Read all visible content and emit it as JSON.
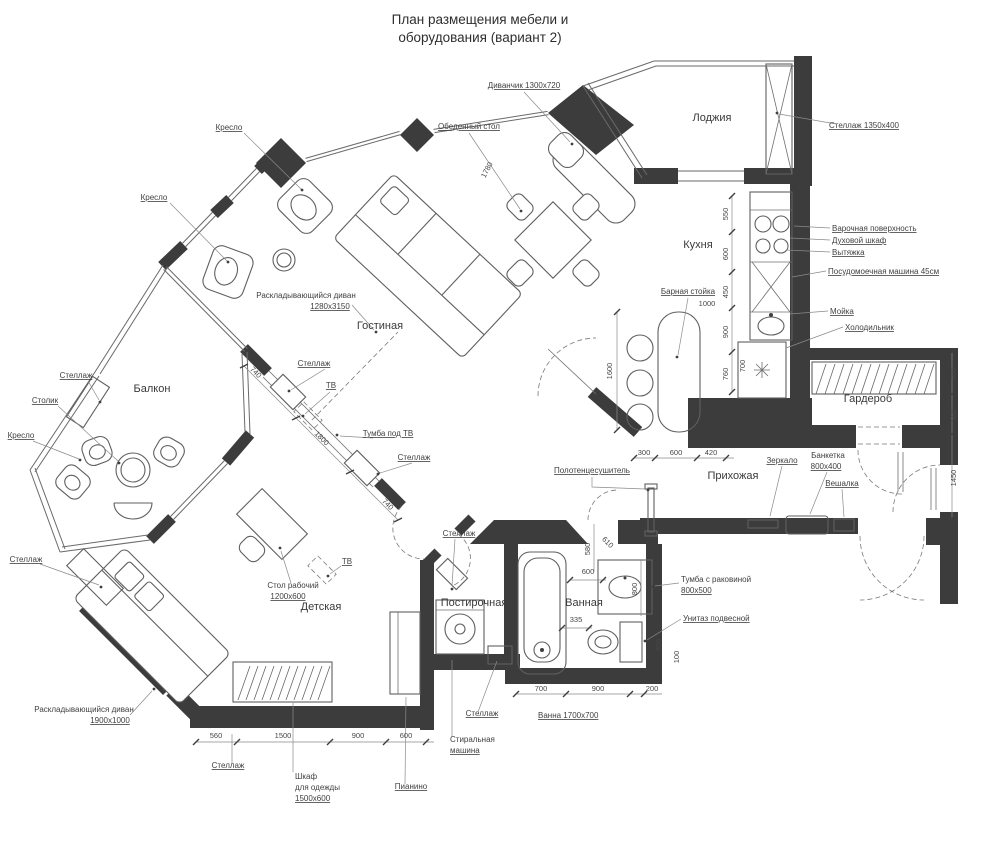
{
  "title": {
    "l1": "План размещения мебели и",
    "l2": "оборудования (вариант 2)"
  },
  "rooms": {
    "loggia": "Лоджия",
    "kitchen": "Кухня",
    "living": "Гостиная",
    "balcony": "Балкон",
    "wardrobe": "Гардероб",
    "hallway": "Прихожая",
    "kids": "Детская",
    "laundry": "Постирочная",
    "bathroom": "Ванная"
  },
  "callouts": {
    "armchair_top1": "Кресло",
    "armchair_top2": "Кресло",
    "small_sofa": "Диванчик 1300х720",
    "dining_table": "Обеденный стол",
    "loggia_shelf": "Стеллаж 1350х400",
    "hob": "Варочная поверхность",
    "oven": "Духовой шкаф",
    "hood": "Вытяжка",
    "dishwasher": "Посудомоечная машина 45см",
    "sink": "Мойка",
    "fridge": "Холодильник",
    "bar": "Барная стойка",
    "living_sofa_1": "Раскладывающийся диван",
    "living_sofa_2": "1280х3150",
    "balcony_shelf": "Стеллаж",
    "balcony_table": "Столик",
    "balcony_chair": "Кресло",
    "tv_shelf_1": "Стеллаж",
    "tv_living": "ТВ",
    "tv_stand": "Тумба под ТВ",
    "tv_shelf_2": "Стеллаж",
    "kids_tv": "ТВ",
    "desk_1": "Стол рабочий",
    "desk_2": "1200х600",
    "kids_shelf_left": "Стеллаж",
    "kids_sofa_1": "Раскладывающийся диван",
    "kids_sofa_2": "1900х1000",
    "towel_rail": "Полотенцесушитель",
    "laundry_shelf_top": "Стеллаж",
    "mirror": "Зеркало",
    "bench_1": "Банкетка",
    "bench_2": "800х400",
    "hanger": "Вешалка",
    "vanity_1": "Тумба с раковиной",
    "vanity_2": "800х500",
    "toilet": "Унитаз подвесной",
    "kids_shelf_bottom": "Стеллаж",
    "closet_1": "Шкаф",
    "closet_2": "для одежды",
    "closet_3": "1500х600",
    "piano": "Пианино",
    "laundry_shelf_bottom": "Стеллаж",
    "washer_1": "Стиральная",
    "washer_2": "машина",
    "bath": "Ванна 1700х700"
  },
  "dims": {
    "k550": "550",
    "k600": "600",
    "k450": "450",
    "k900": "900",
    "k760": "760",
    "k1000": "1000",
    "k700": "700",
    "k1600": "1600",
    "k300": "300",
    "k600b": "600",
    "k420": "420",
    "r600": "600",
    "r580": "580",
    "r1450": "1450",
    "w740a": "740",
    "w1800": "1800",
    "w740b": "740",
    "d1780": "1780",
    "b610": "610",
    "b600": "600",
    "b335": "335",
    "b800a": "800",
    "b800b": "800",
    "b100": "100",
    "b580": "580",
    "f560": "560",
    "f1500": "1500",
    "f900": "900",
    "f600": "600",
    "g700": "700",
    "g900": "900",
    "g200": "200"
  }
}
